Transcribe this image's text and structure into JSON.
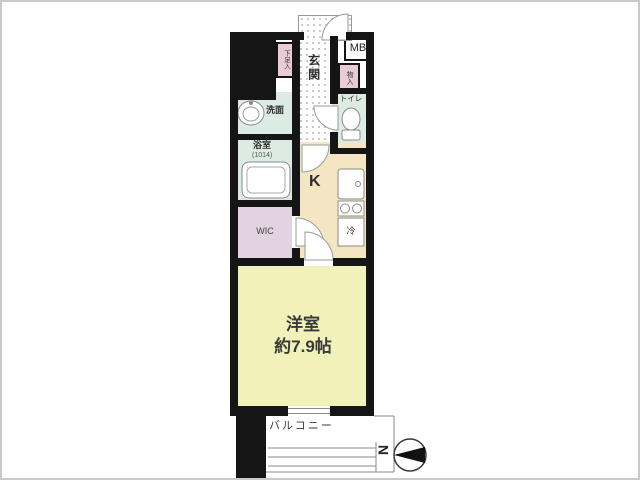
{
  "labels": {
    "ps": "PS",
    "mb": "MB",
    "shoe_box": "下足入",
    "entrance": "玄関",
    "storage": "物入",
    "toilet": "トイレ",
    "washroom": "洗面",
    "bathroom": "浴室",
    "bathroom_size": "(1014)",
    "kitchen": "K",
    "wic": "WIC",
    "washer": "洗濯機",
    "fridge": "冷",
    "shelf": "棚",
    "main_room": "洋室",
    "main_room_area": "約7.9帖",
    "balcony": "バルコニー",
    "north": "N"
  },
  "colors": {
    "wall": "#151515",
    "wet_rooms": "#dcebe4",
    "kitchen": "#f4e6c3",
    "bedroom": "#f1f1ba",
    "wic": "#e2d3e1",
    "storage_pink": "#eaccd6",
    "frame": "#c9c9c9"
  }
}
